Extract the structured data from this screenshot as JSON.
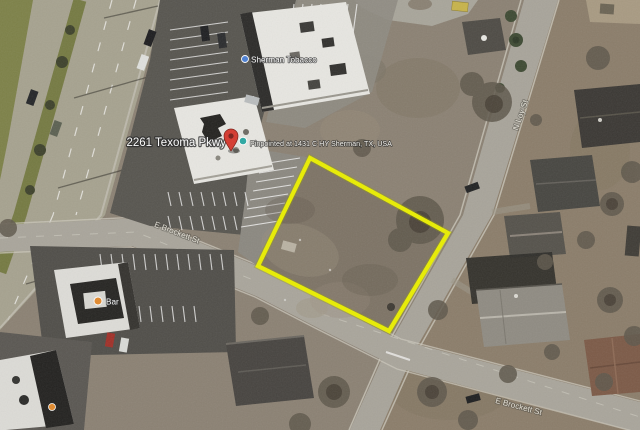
{
  "window": {
    "width": 640,
    "height": 430,
    "kind": "satellite-aerial-map"
  },
  "map": {
    "marker": {
      "address_label": "2261 Texoma Pkwy",
      "geocode_label": "Pinpointed at 1431 C HY Sherman, TX, USA",
      "pin_icon": "red-map-pin-icon",
      "secondary_icon": "teal-dot-icon"
    },
    "pois": [
      {
        "label": "Sherman Tobacco",
        "icon": "blue-poi-dot-icon"
      },
      {
        "label": "Bar",
        "icon": "orange-poi-dot-icon"
      }
    ],
    "streets": {
      "ew": "E Brockett St",
      "ew2": "E Brockett St",
      "ns": "N Loy St"
    },
    "colors": {
      "boundary": "#e9ee00",
      "pin": "#d6392e",
      "ground": "#8b8173",
      "road": "#a8a49a",
      "highway": "#a6a28f",
      "asphalt": "#56544f",
      "roof_white": "#e7e6e1"
    }
  }
}
